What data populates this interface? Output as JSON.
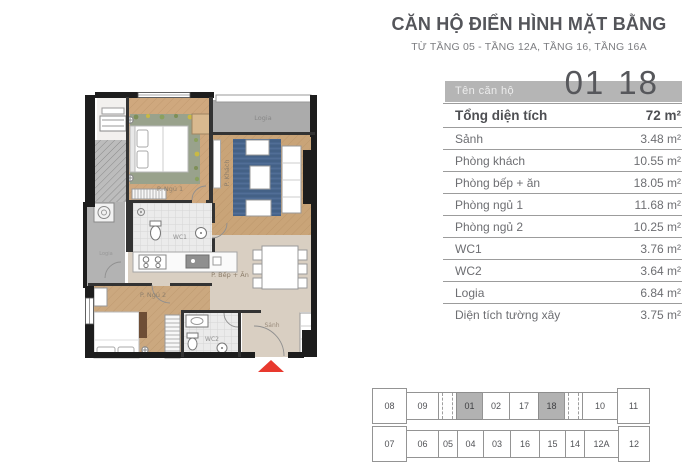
{
  "header": {
    "title": "CĂN HỘ ĐIỂN HÌNH MẶT BẰNG",
    "subtitle": "TỪ TẦNG 05 - TẦNG 12A, TẦNG 16, TẦNG 16A"
  },
  "unit": {
    "label": "Tên căn hộ",
    "number_left": "01",
    "number_right": "18"
  },
  "area_table": {
    "rows": [
      {
        "label": "Tổng diện tích",
        "value": "72 m²"
      },
      {
        "label": "Sảnh",
        "value": "3.48 m²"
      },
      {
        "label": "Phòng khách",
        "value": "10.55 m²"
      },
      {
        "label": "Phòng bếp + ăn",
        "value": "18.05 m²"
      },
      {
        "label": "Phòng ngủ 1",
        "value": "11.68 m²"
      },
      {
        "label": "Phòng ngủ 2",
        "value": "10.25 m²"
      },
      {
        "label": "WC1",
        "value": "3.76 m²"
      },
      {
        "label": "WC2",
        "value": "3.64 m²"
      },
      {
        "label": "Logia",
        "value": "6.84 m²"
      },
      {
        "label": "Diện tích tường xây",
        "value": "3.75 m²"
      }
    ]
  },
  "floor_plan": {
    "labels": {
      "bedroom1": "P. Ngủ 1",
      "living": "P. Khách",
      "logia_top": "Logia",
      "logia_left": "Logia",
      "wc1": "WC1",
      "kitchen": "P. Bếp + Ăn",
      "bedroom2": "P. Ngủ 2",
      "wc2": "WC2",
      "hall": "Sảnh"
    },
    "entrance_marker": "red-arrow"
  },
  "key_plan": {
    "top_row": [
      "08",
      "09",
      "",
      "01",
      "02",
      "17",
      "18",
      "",
      "10",
      "11"
    ],
    "bottom_row": [
      "07",
      "06",
      "05",
      "04",
      "03",
      "16",
      "15",
      "14",
      "12A",
      "12"
    ],
    "highlighted_units": [
      "01",
      "18"
    ]
  },
  "colors": {
    "accent_red": "#e8392e",
    "band_gray": "#b5b5b5",
    "highlight_gray": "#b2b2b2",
    "text_dark": "#54555a",
    "wood_floor": "#cfa87e",
    "rug_blue": "#49668e",
    "beige_floor": "#d9cfc2"
  }
}
